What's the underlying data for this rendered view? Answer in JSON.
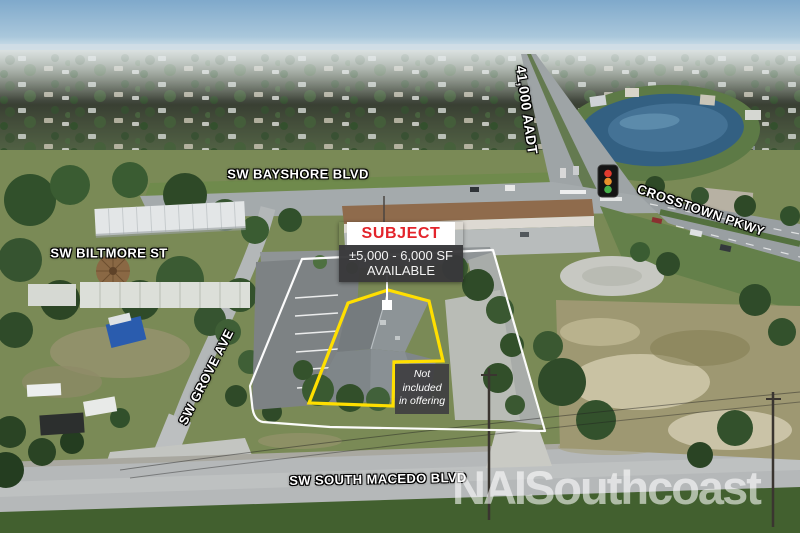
{
  "streets": {
    "bayshore": {
      "label": "SW BAYSHORE BLVD"
    },
    "biltmore": {
      "label": "SW BILTMORE ST"
    },
    "grove": {
      "label": "SW GROVE AVE"
    },
    "macedo": {
      "label": "SW SOUTH MACEDO BLVD"
    },
    "crosstown": {
      "label": "CROSSTOWN PKWY"
    },
    "aadt": {
      "label": "41,000 AADT"
    }
  },
  "callout": {
    "title": "SUBJECT",
    "size_line": "±5,000 - 6,000 SF",
    "availability_line": "AVAILABLE"
  },
  "exclusion": {
    "line1": "Not",
    "line2": "included",
    "line3": "in offering"
  },
  "logo": {
    "prefix": "NAI",
    "name": "Southcoast"
  },
  "colors": {
    "subject_red": "#e3242b",
    "label_dark_bg": "#3a3a3c",
    "outline_yellow": "#ffdf00",
    "boundary_white": "#ffffff",
    "traffic_red": "#e03a2f",
    "traffic_amber": "#e8912c",
    "traffic_green": "#46b04a"
  }
}
